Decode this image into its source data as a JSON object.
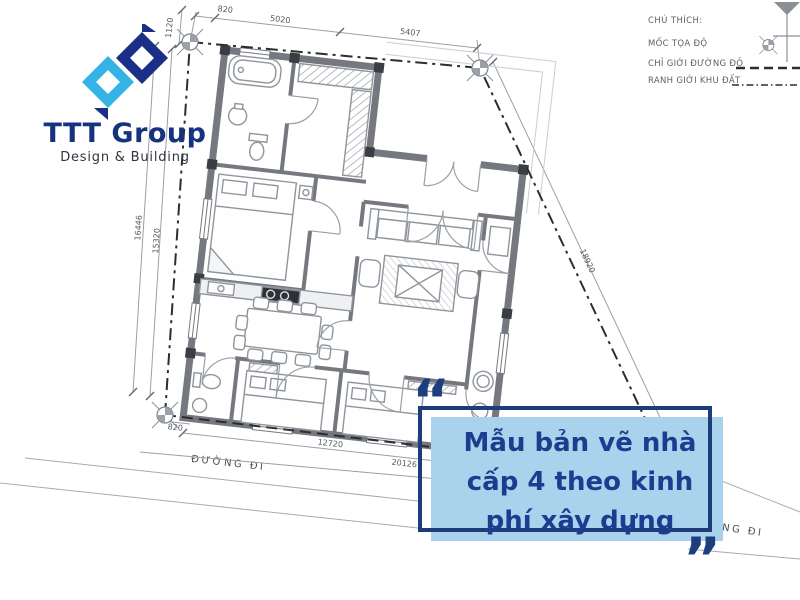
{
  "brand": {
    "name": "TTT Group",
    "tagline": "Design & Building"
  },
  "legend": {
    "title": "CHÚ THÍCH:",
    "items": [
      {
        "label": "MỐC TỌA ĐỘ",
        "symbol": "survey-marker"
      },
      {
        "label": "CHỈ GIỚI ĐƯỜNG ĐỎ",
        "symbol": "dashed-line"
      },
      {
        "label": "RANH GIỚI KHU ĐẤT",
        "symbol": "dash-dot-line"
      }
    ]
  },
  "dimensions": {
    "top": [
      "820",
      "5020",
      "5407"
    ],
    "top_left": "1120",
    "left": [
      "16446",
      "15320"
    ],
    "right": "18920",
    "bottom": [
      "820",
      "12720",
      "20126"
    ]
  },
  "roads": {
    "bottom_label": "ĐƯỜNG ĐI",
    "right_label": "ĐƯỜNG ĐI"
  },
  "quote": {
    "text": "Mẫu bản vẽ nhà cấp 4 theo kinh phí xây dựng",
    "open_mark": "“",
    "close_mark": "”"
  },
  "colors": {
    "navy": "#1e3c7a",
    "quote_text": "#1e3c8f",
    "light_blue": "#a9d2ec",
    "logo_navy": "#1c2f86",
    "logo_cyan": "#36b3e6",
    "wall_gray": "#75797f",
    "boundary_black": "#2b2d30"
  }
}
